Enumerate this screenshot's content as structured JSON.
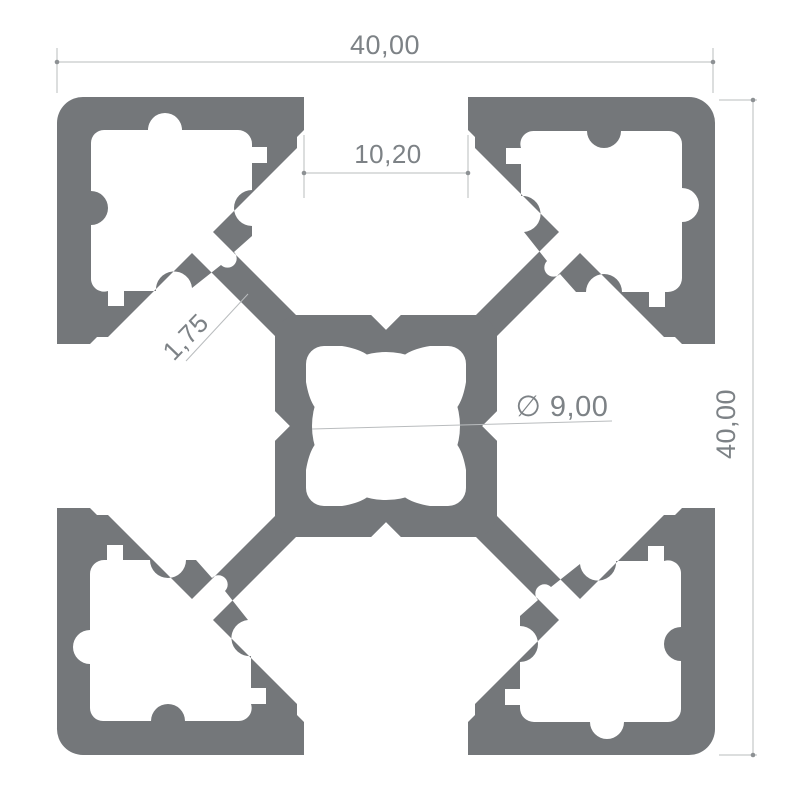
{
  "colors": {
    "background": "#ffffff",
    "profile": "#74777A",
    "dim_line": "#b9bcbe",
    "dim_tick": "#8d9194",
    "dim_text": "#7d8286"
  },
  "dimensions": {
    "width": {
      "label": "40,00"
    },
    "height": {
      "label": "40,00"
    },
    "slot_opening": {
      "label": "10,20"
    },
    "wall_thickness": {
      "label": "1,75"
    },
    "center_bore": {
      "label": "∅ 9,00"
    }
  }
}
